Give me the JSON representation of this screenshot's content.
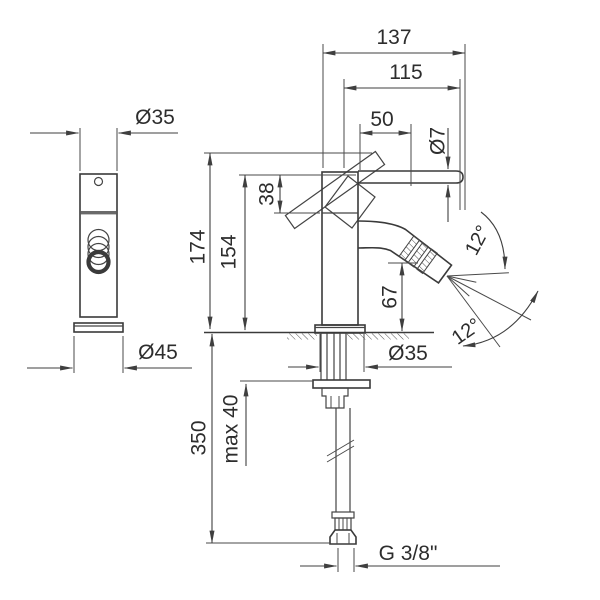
{
  "drawing": {
    "kind": "technical-dimension-drawing",
    "subject": "single-lever bidet mixer with adjustable spray and flexible supply hose"
  },
  "labels": {
    "total_projection": "137",
    "handle_projection": "115",
    "handle_grip_length": "50",
    "handle_rod_diameter": "Ø7",
    "body_diameter_front": "Ø35",
    "base_diameter": "Ø45",
    "total_height": "174",
    "body_height": "154",
    "handle_drop": "38",
    "spout_height": "67",
    "shank_diameter": "Ø35",
    "max_counter_thickness": "max 40",
    "hose_length": "350",
    "hose_thread": "G 3/8\"",
    "spray_angle_upper": "12°",
    "spray_angle_lower": "12°"
  },
  "colors": {
    "line": "#444444",
    "text": "#2d2d2d",
    "background": "#ffffff"
  }
}
